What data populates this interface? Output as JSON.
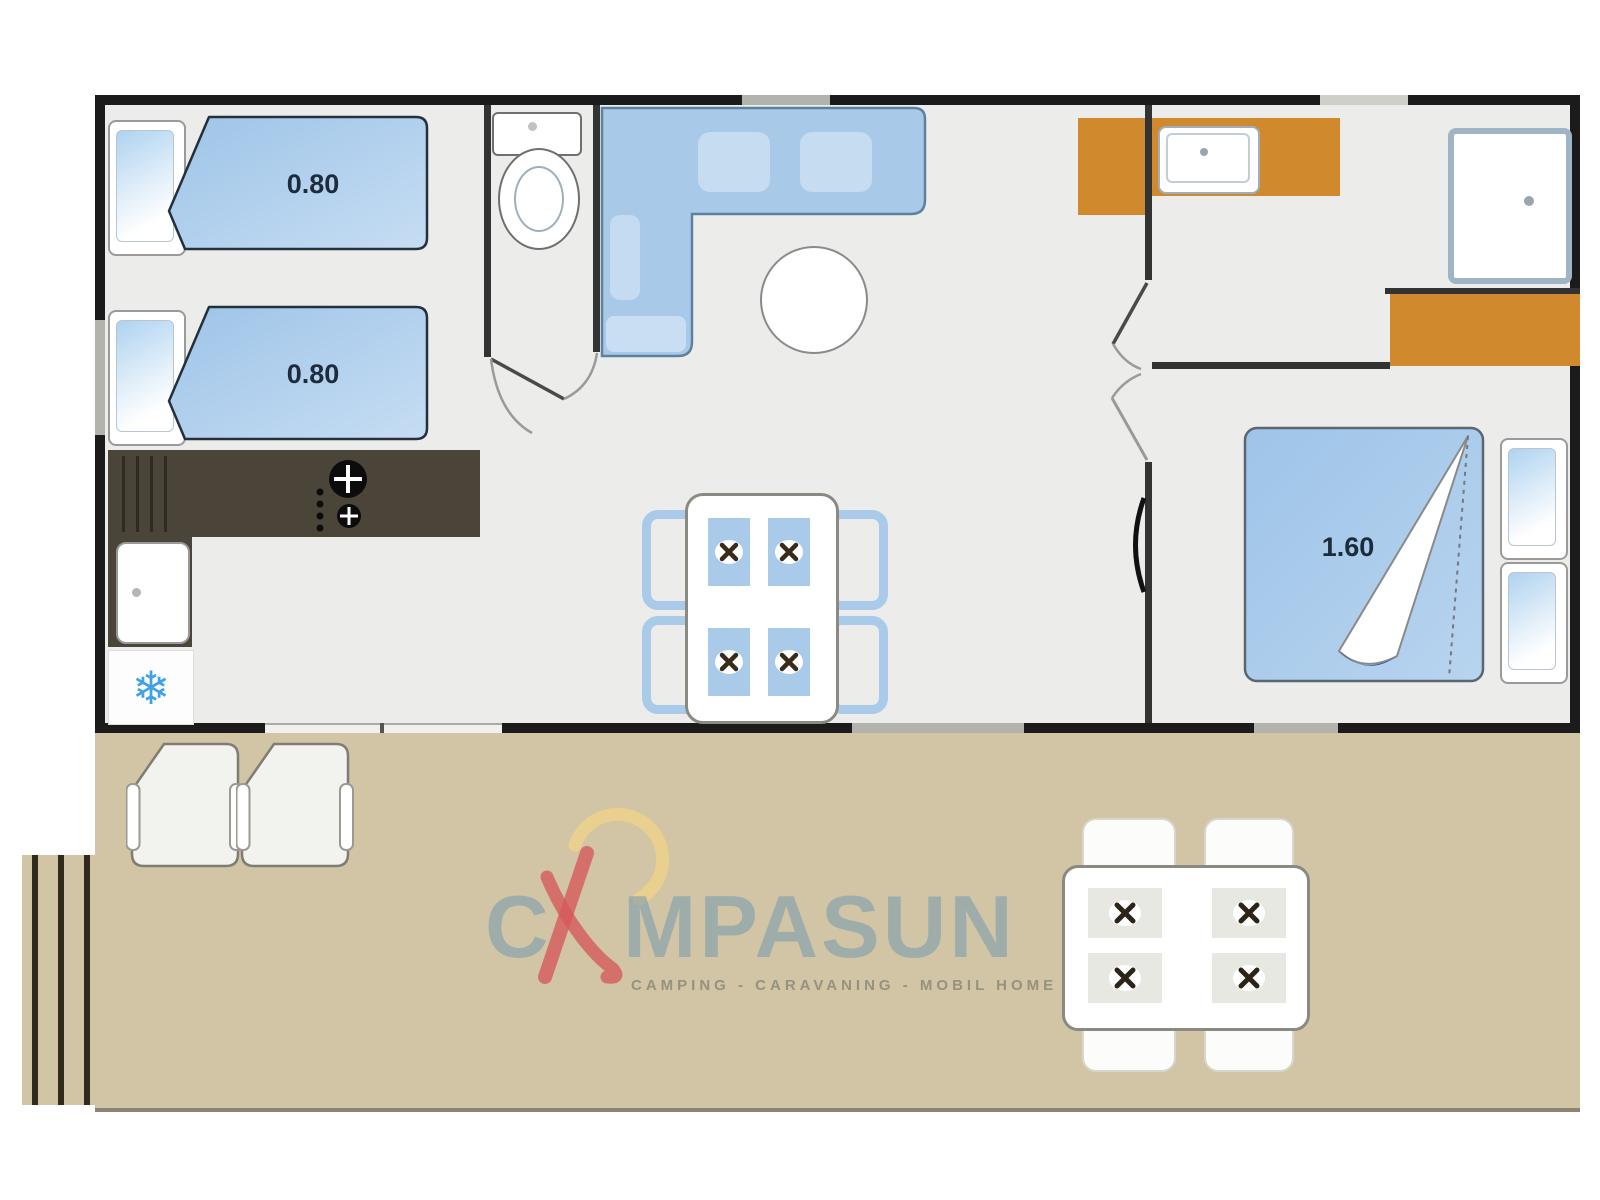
{
  "title": "Campasun mobile home floor plan",
  "logo": {
    "name": "CAMPASUN",
    "part1": "C",
    "part2": "MPASUN",
    "tagline": "CAMPING - CARAVANING - MOBIL HOME"
  },
  "rooms": {
    "kids_bedroom": {
      "bed1_label": "0.80",
      "bed2_label": "0.80"
    },
    "master_bedroom": {
      "bed_label": "1.60"
    }
  },
  "colors": {
    "wall": "#1b1b1b",
    "floor": "#ececeb",
    "furniture_blue": "#a9cbe9",
    "wood_orange": "#d08a2d",
    "counter_dark": "#4b4439",
    "terrace_tan": "#d1c5a6",
    "logo_blue": "#7d9cad",
    "logo_red": "#d4595a",
    "logo_yellow": "#f2d386",
    "snowflake_blue": "#3fa3e3"
  }
}
